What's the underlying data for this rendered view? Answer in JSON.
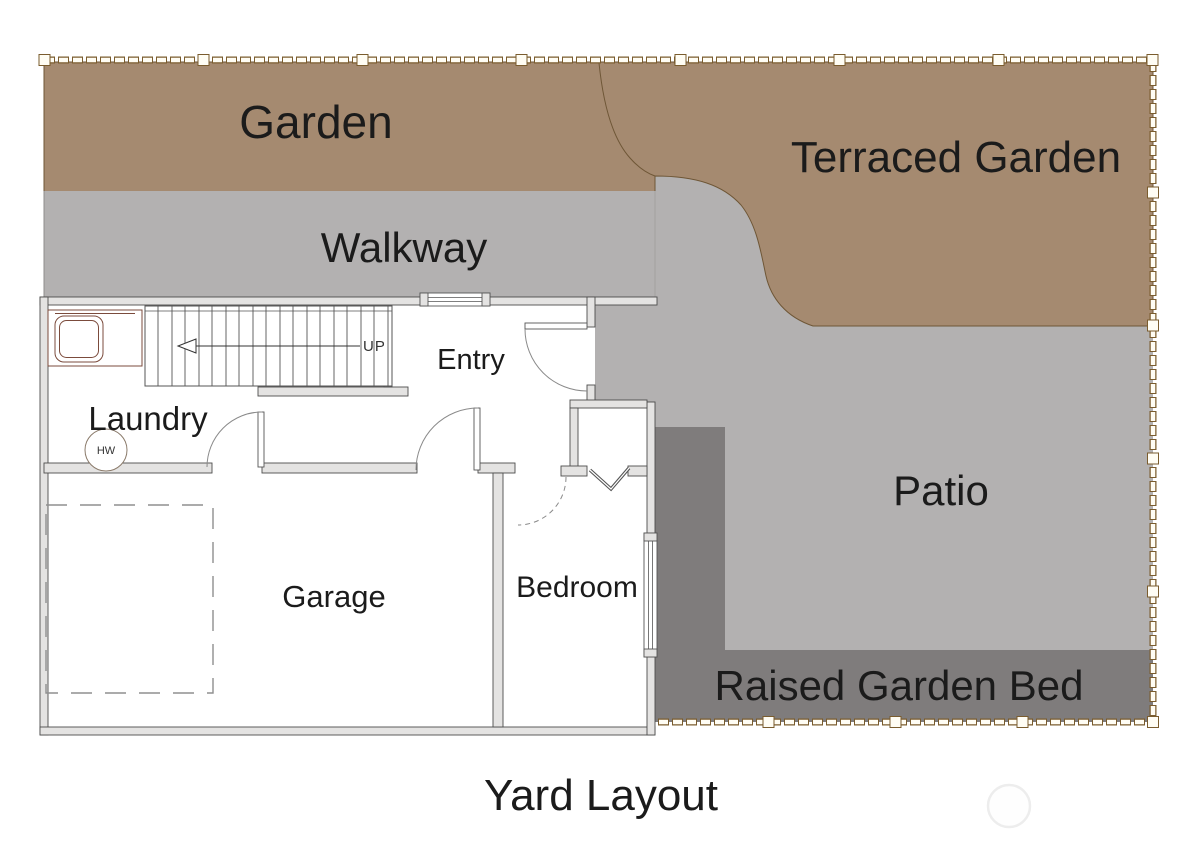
{
  "title": {
    "text": "Yard Layout"
  },
  "areas": {
    "garden": {
      "label": "Garden"
    },
    "terraced_garden": {
      "label": "Terraced Garden"
    },
    "walkway": {
      "label": "Walkway"
    },
    "patio": {
      "label": "Patio"
    },
    "raised_garden_bed": {
      "label": "Raised Garden Bed"
    }
  },
  "rooms": {
    "entry": {
      "label": "Entry"
    },
    "laundry": {
      "label": "Laundry"
    },
    "garage": {
      "label": "Garage"
    },
    "bedroom": {
      "label": "Bedroom"
    }
  },
  "annotations": {
    "stair_direction": "UP",
    "water_heater": "HW"
  },
  "colors": {
    "garden": "#a58a70",
    "garden_edge": "#6e5636",
    "walkway": "#b3b1b1",
    "patio": "#b3b1b1",
    "raised_bed": "#7f7c7c",
    "fence": "#7a5c2e",
    "fence_fill": "#fffdf4"
  }
}
